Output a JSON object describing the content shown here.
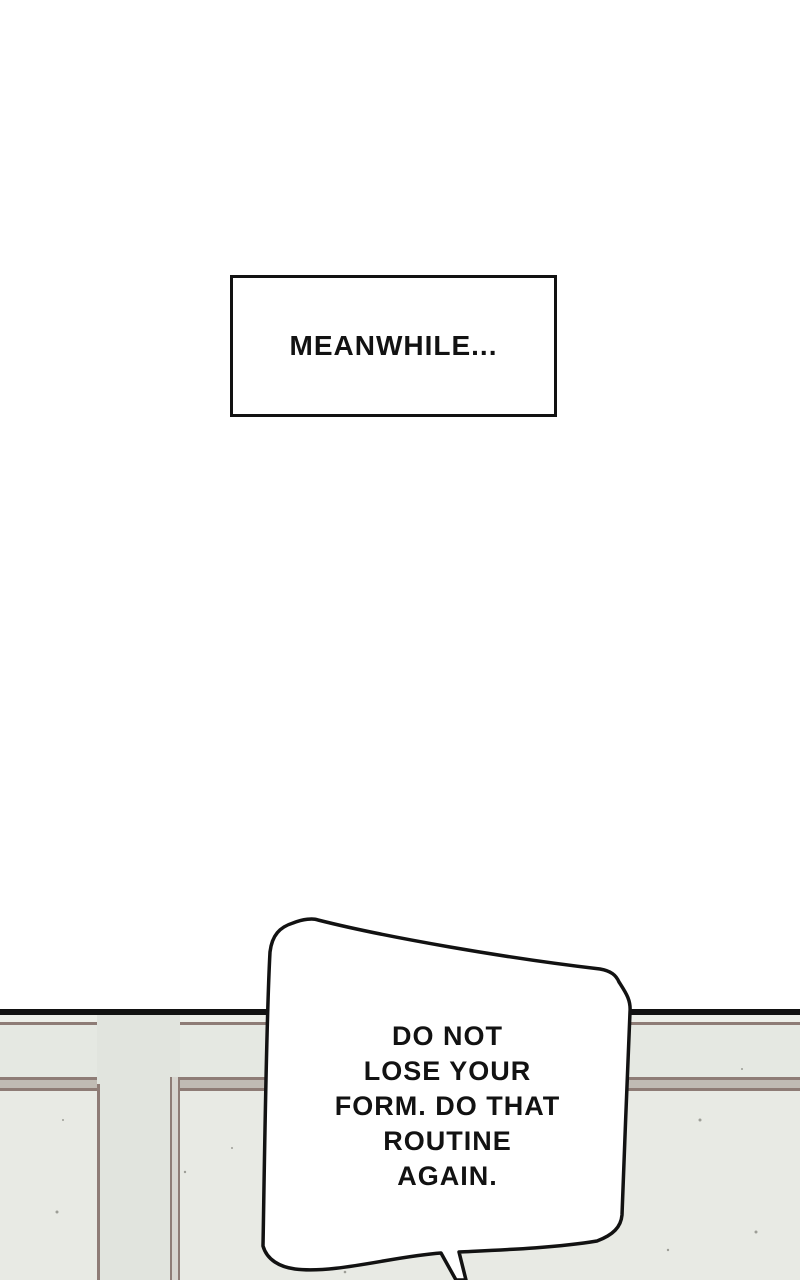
{
  "caption": {
    "text": "MEANWHILE..."
  },
  "bubble": {
    "full_text": "DO NOT LOSE YOUR FORM. DO THAT ROUTINE AGAIN.",
    "lines": [
      "DO NOT",
      "LOSE YOUR",
      "FORM. DO THAT",
      "ROUTINE",
      "AGAIN."
    ]
  },
  "colors": {
    "ink": "#121212",
    "paper": "#ffffff",
    "wall": "#e5e8e2",
    "wall-upper": "#edefe9",
    "panel": "#e8eae4",
    "pillar": "#e1e4de",
    "pillar-shade": "#d7d5cf",
    "trim": "#8e7c76",
    "rail-gray": "#c0bbb4",
    "speck": "#5f5e58"
  }
}
